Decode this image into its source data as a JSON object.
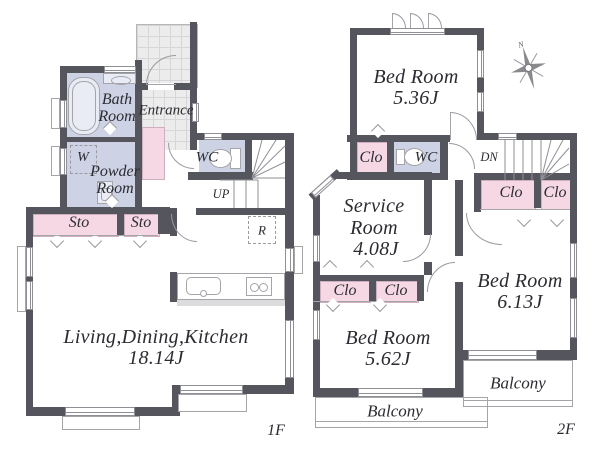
{
  "colors": {
    "wall": "#55555d",
    "wet_room_blue": "#cdd3e5",
    "storage_pink": "#f5d8e4",
    "tile_gray": "#edecec",
    "line_gray": "#9a9a9f",
    "text": "#2b2b31"
  },
  "floor1": {
    "floor_label": "1F",
    "bath_line1": "Bath",
    "bath_line2": "Room",
    "powder_line1": "Powder",
    "powder_line2": "Room",
    "entrance": "Entrance",
    "wc": "WC",
    "washer": "W",
    "fridge": "R",
    "up": "UP",
    "sto_left": "Sto",
    "sto_right": "Sto",
    "ldk_name": "Living,Dining,Kitchen",
    "ldk_area": "18.14J"
  },
  "floor2": {
    "floor_label": "2F",
    "bed1_name": "Bed Room",
    "bed1_area": "5.36J",
    "bed2_name": "Bed Room",
    "bed2_area": "5.62J",
    "bed3_name": "Bed Room",
    "bed3_area": "6.13J",
    "service_line1": "Service",
    "service_line2": "Room",
    "service_area": "4.08J",
    "wc": "WC",
    "dn": "DN",
    "clo_hall": "Clo",
    "clo_service_left": "Clo",
    "clo_service_right": "Clo",
    "clo_bed3_left": "Clo",
    "clo_bed3_right": "Clo",
    "balcony_left": "Balcony",
    "balcony_right": "Balcony",
    "compass_north": "N"
  }
}
